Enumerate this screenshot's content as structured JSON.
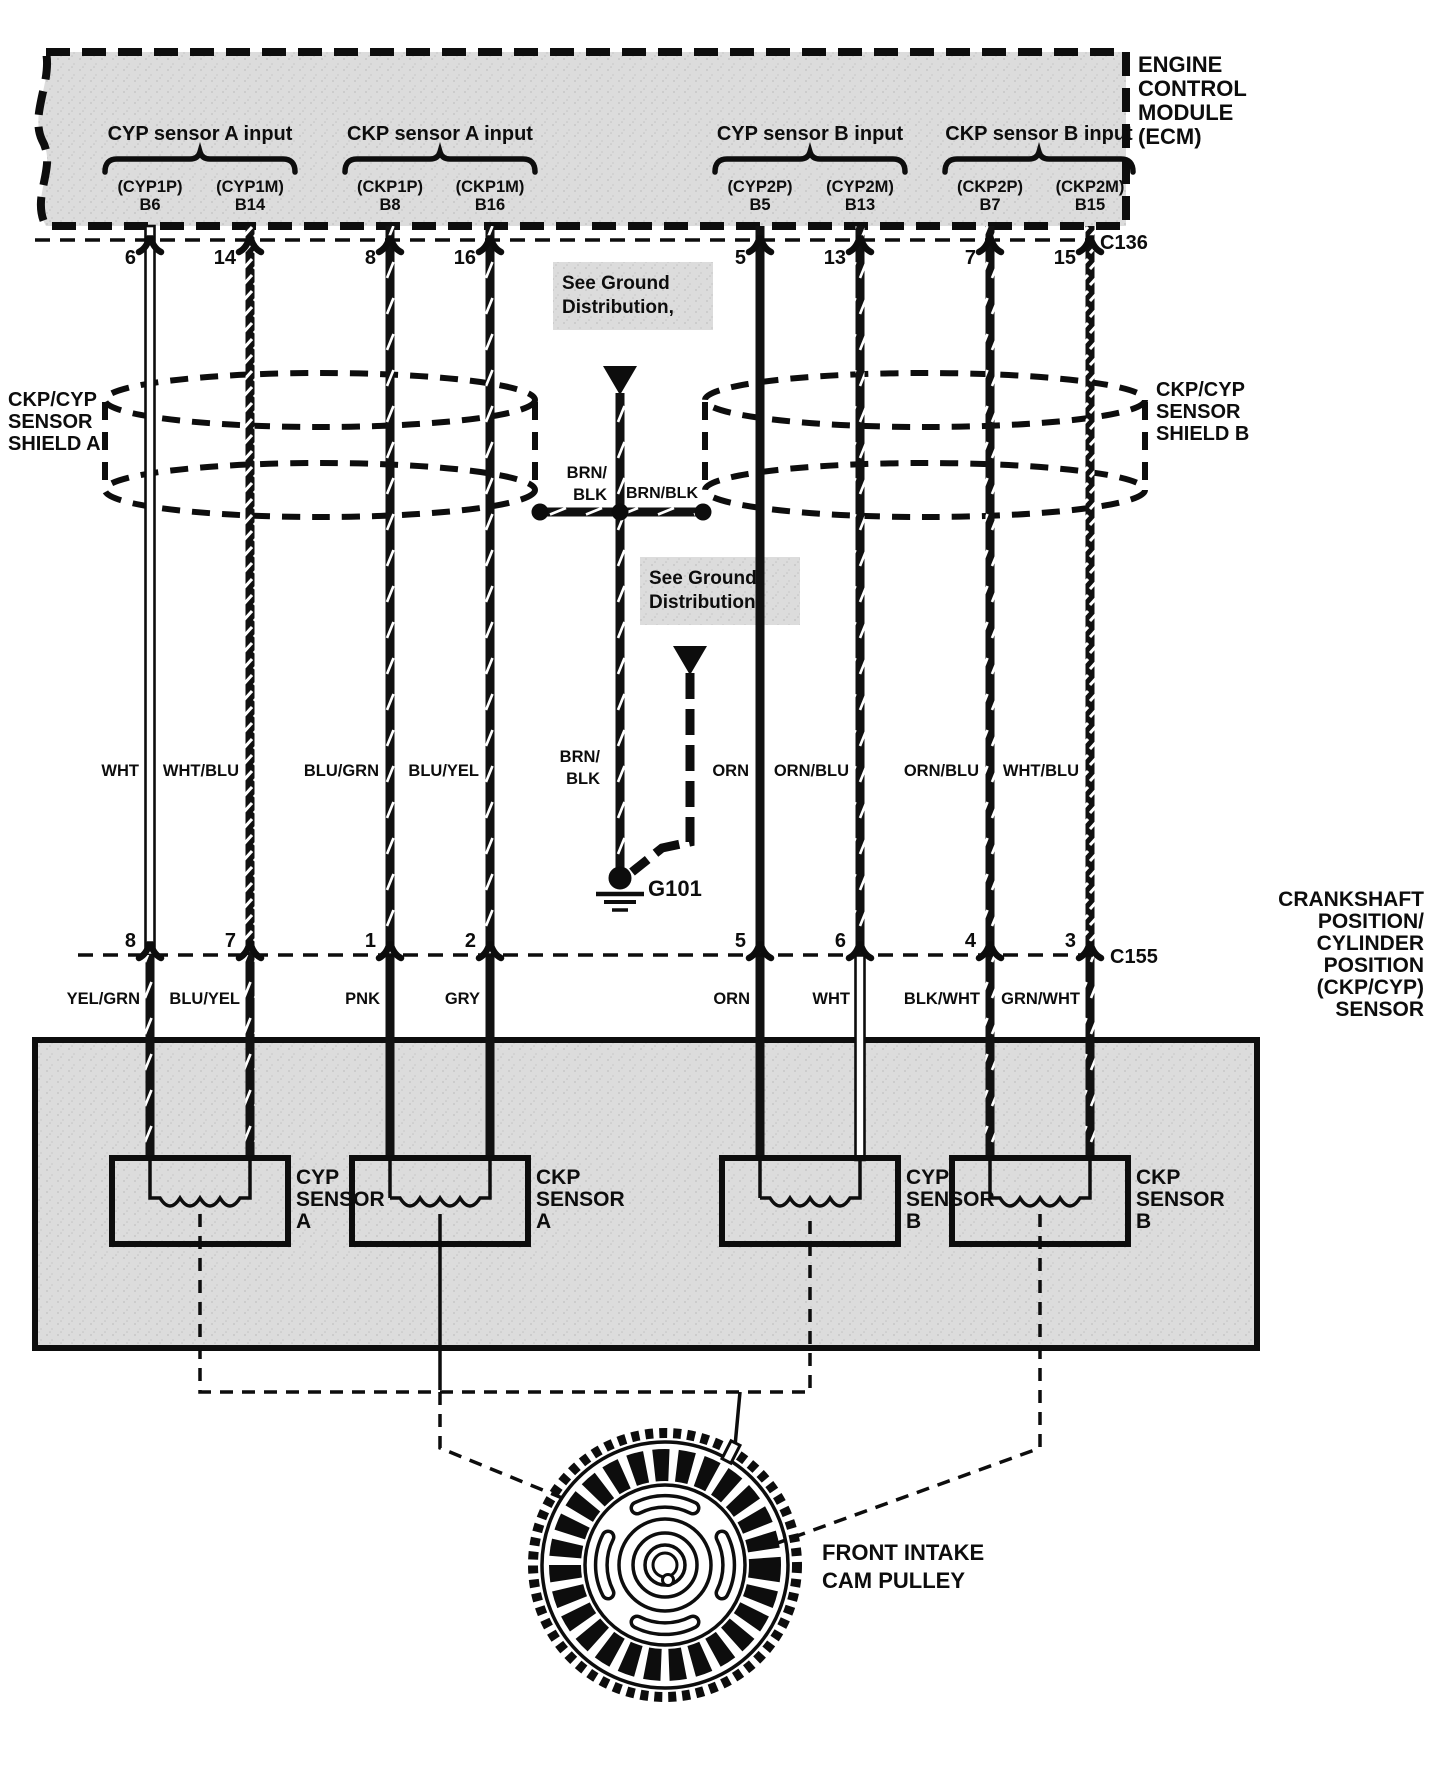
{
  "ecm": {
    "name_lines": [
      "ENGINE",
      "CONTROL",
      "MODULE",
      "(ECM)"
    ],
    "groups": [
      {
        "label": "CYP sensor A input",
        "pin_names": [
          "(CYP1P)",
          "(CYP1M)"
        ],
        "pin_ids": [
          "B6",
          "B14"
        ]
      },
      {
        "label": "CKP sensor A input",
        "pin_names": [
          "(CKP1P)",
          "(CKP1M)"
        ],
        "pin_ids": [
          "B8",
          "B16"
        ]
      },
      {
        "label": "CYP sensor B input",
        "pin_names": [
          "(CYP2P)",
          "(CYP2M)"
        ],
        "pin_ids": [
          "B5",
          "B13"
        ]
      },
      {
        "label": "CKP sensor B input",
        "pin_names": [
          "(CKP2P)",
          "(CKP2M)"
        ],
        "pin_ids": [
          "B7",
          "B15"
        ]
      }
    ]
  },
  "connectors": {
    "top": "C136",
    "bottom": "C155"
  },
  "pins_top": [
    "6",
    "14",
    "8",
    "16",
    "5",
    "13",
    "7",
    "15"
  ],
  "pins_bottom": [
    "8",
    "7",
    "1",
    "2",
    "5",
    "6",
    "4",
    "3"
  ],
  "wire_colors_mid": [
    "WHT",
    "WHT/BLU",
    "BLU/GRN",
    "BLU/YEL",
    "ORN",
    "ORN/BLU",
    "ORN/BLU",
    "WHT/BLU"
  ],
  "wire_colors_bottom": [
    "YEL/GRN",
    "BLU/YEL",
    "PNK",
    "GRY",
    "ORN",
    "WHT",
    "BLK/WHT",
    "GRN/WHT"
  ],
  "ground": {
    "note_line1": "See Ground",
    "note_line2": "Distribution,",
    "brnblk_split": [
      "BRN/",
      "BLK"
    ],
    "brnblk": "BRN/BLK",
    "g101": "G101"
  },
  "shield_a": [
    "CKP/CYP",
    "SENSOR",
    "SHIELD A"
  ],
  "shield_b": [
    "CKP/CYP",
    "SENSOR",
    "SHIELD B"
  ],
  "ckp_cyp_sensor_label": [
    "CRANKSHAFT",
    "POSITION/",
    "CYLINDER",
    "POSITION",
    "(CKP/CYP)",
    "SENSOR"
  ],
  "sensors": [
    {
      "lines": [
        "CYP",
        "SENSOR",
        "A"
      ]
    },
    {
      "lines": [
        "CKP",
        "SENSOR",
        "A"
      ]
    },
    {
      "lines": [
        "CYP",
        "SENSOR",
        "B"
      ]
    },
    {
      "lines": [
        "CKP",
        "SENSOR",
        "B"
      ]
    }
  ],
  "pulley": {
    "line1": "FRONT INTAKE",
    "line2": "CAM PULLEY"
  }
}
